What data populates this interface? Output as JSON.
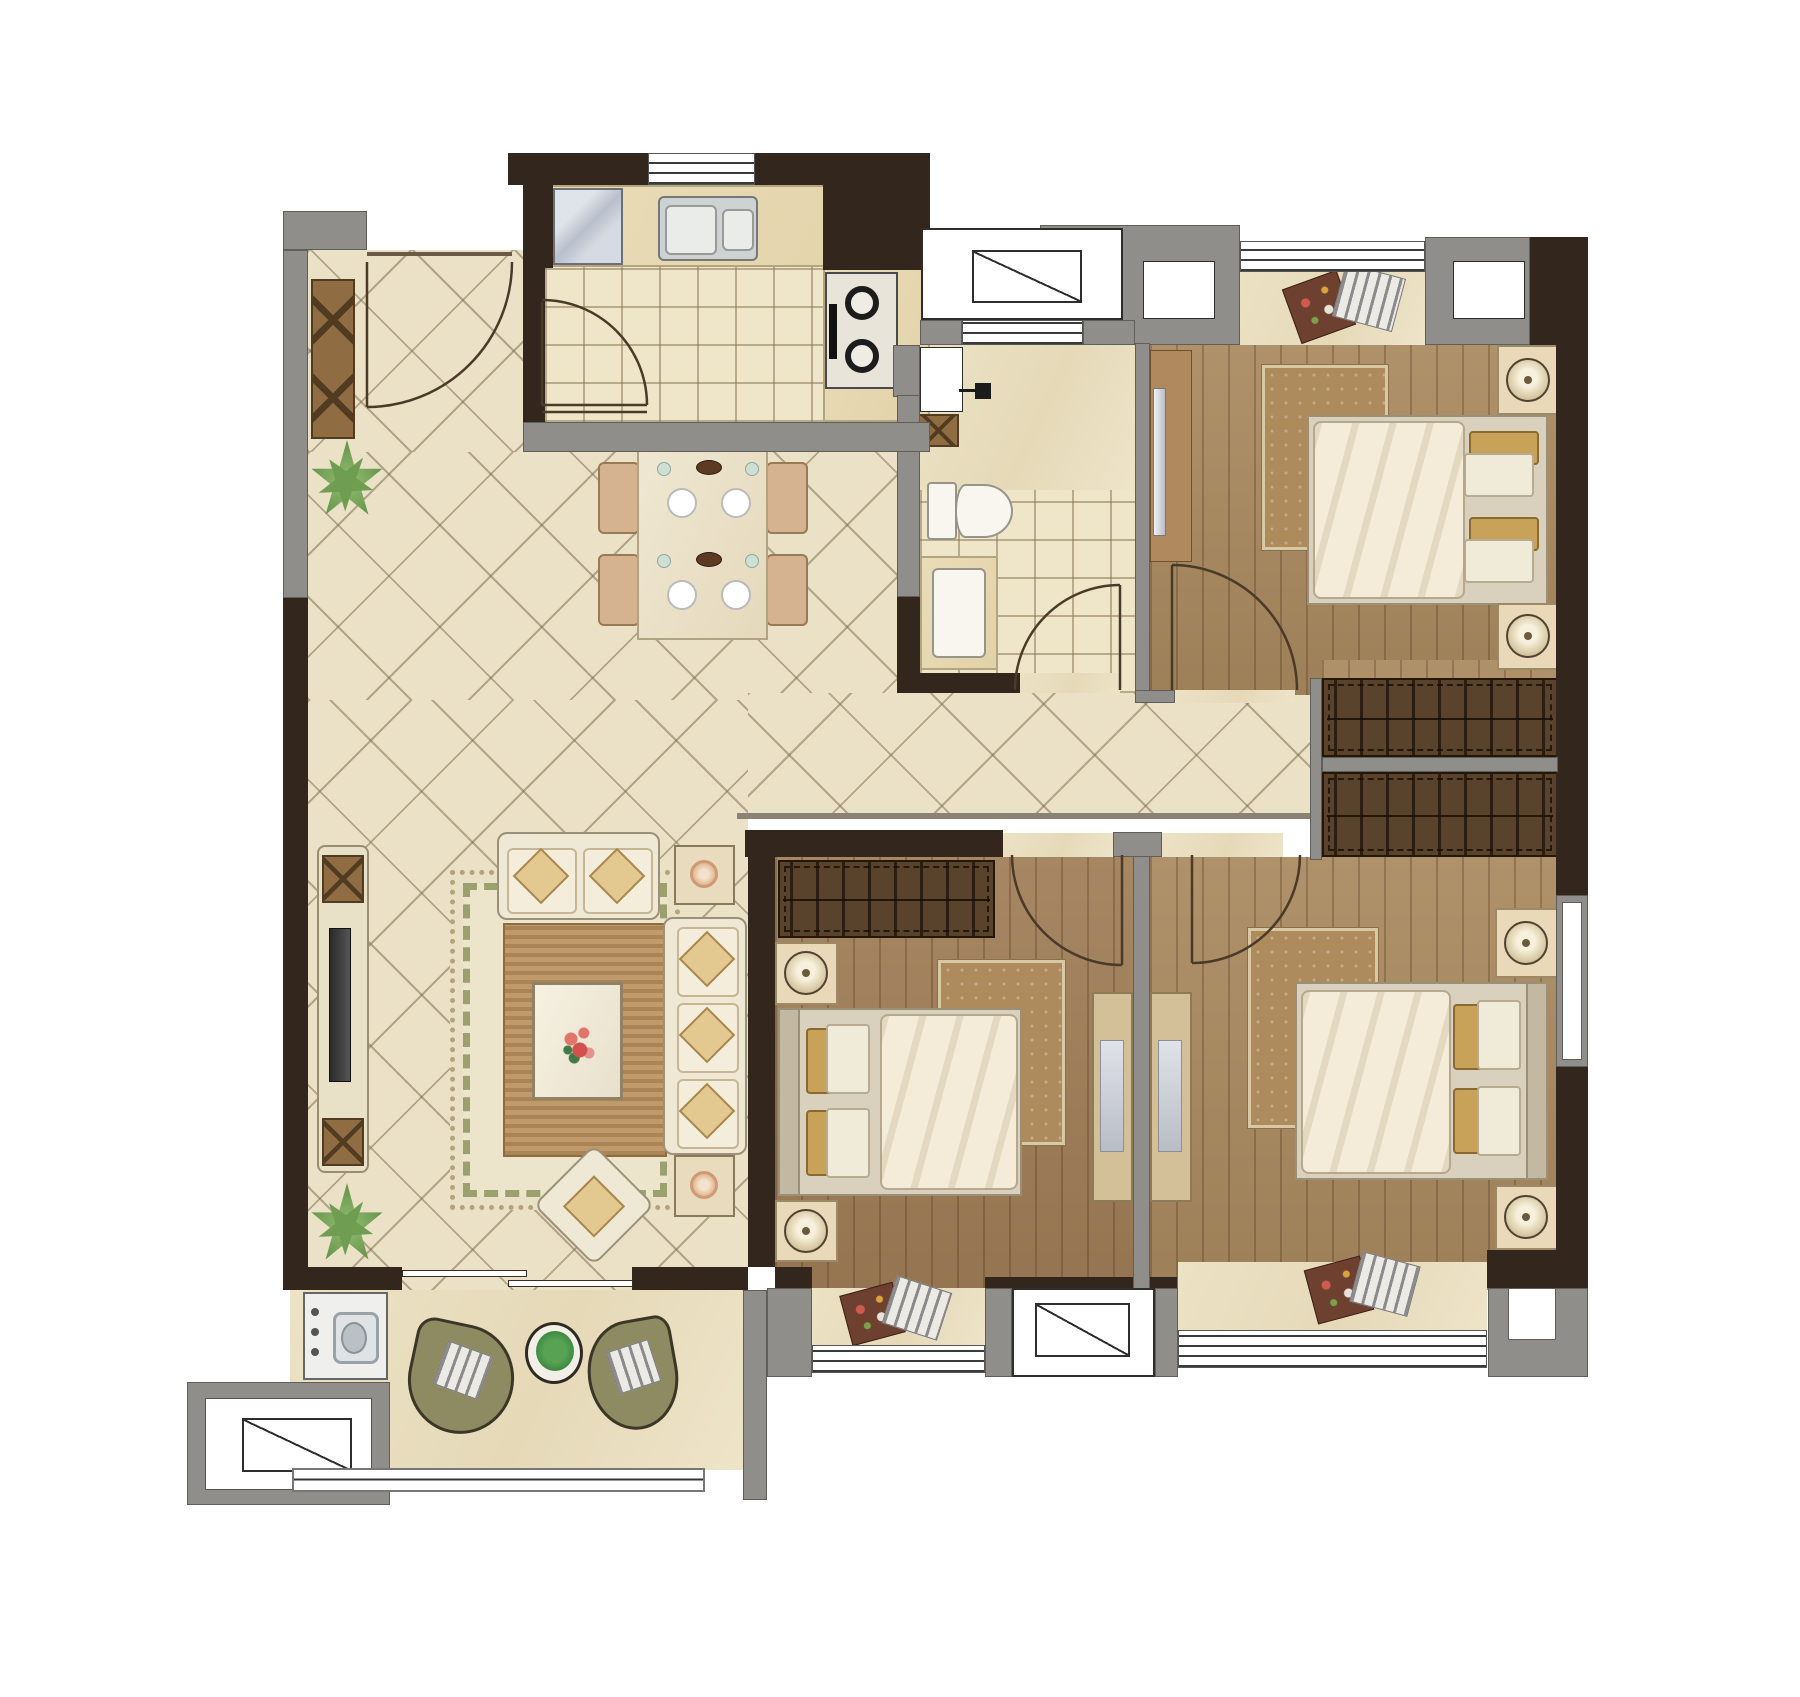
{
  "canvas": {
    "width": 1800,
    "height": 1697,
    "background": "#ffffff"
  },
  "palette": {
    "wall_structural": "#33261c",
    "wall_partition": "#8f8e8a",
    "diamond_tile_floor": "#ebe1c7",
    "square_tile_floor": "#efe5c9",
    "wood_floor": "#a9895f",
    "marble_sill": "#e9ddc0",
    "counter_marble": "#e7dcba",
    "dark_wood_furniture": "#59432c",
    "sofa_cream": "#efe8d4",
    "cushion_tan": "#c7a258",
    "balcony_chair_olive": "#8e8a62",
    "plant_green": "#6f9e52",
    "appliance_steel": "#c9cdd4"
  },
  "rooms": {
    "entry": {
      "name": "entry hall",
      "floor": "diamond tile",
      "items": [
        "entry swing door",
        "shoe cabinet",
        "potted plant"
      ]
    },
    "kitchen": {
      "name": "kitchen",
      "floor": "square tile",
      "items": [
        "refrigerator",
        "L-shaped counter",
        "double-bowl sink",
        "two-burner gas cooktop",
        "window",
        "swing door"
      ]
    },
    "dining": {
      "name": "dining area",
      "floor": "diamond tile",
      "items": [
        "dining table for four",
        "4 dining chairs",
        "4 place settings"
      ]
    },
    "living": {
      "name": "living room",
      "floor": "diamond tile",
      "items": [
        "tv console",
        "television",
        "fringed area rug",
        "loveseat",
        "three-seat sofa",
        "coffee table",
        "flower centerpiece",
        "2 end tables with lamps",
        "ottoman",
        "2 potted plants",
        "sliding balcony door"
      ]
    },
    "corridor": {
      "name": "hallway",
      "floor": "diamond tile",
      "items": []
    },
    "bathroom": {
      "name": "bathroom",
      "floor": "marble + square tile",
      "items": [
        "toilet",
        "vanity washbasin",
        "washer tap",
        "storage cabinet",
        "window",
        "swing door"
      ]
    },
    "bedroom1": {
      "name": "bedroom top right",
      "floor": "wood plank",
      "items": [
        "double bed",
        "duvet",
        "4 pillows",
        "2 nightstands with lamps",
        "area rug",
        "tv panel",
        "wardrobe",
        "bay window seat with 2 cushions",
        "swing door"
      ]
    },
    "bedroom2": {
      "name": "bedroom bottom middle",
      "floor": "wood plank",
      "items": [
        "double bed",
        "duvet",
        "4 pillows",
        "2 nightstands with lamps",
        "area rug",
        "wardrobe",
        "desk",
        "bay window seat with 2 cushions",
        "swing door"
      ]
    },
    "bedroom3": {
      "name": "bedroom bottom right",
      "floor": "wood plank",
      "items": [
        "double bed",
        "duvet",
        "4 pillows",
        "2 nightstands with lamps",
        "area rug",
        "wardrobe",
        "desk",
        "bay window seat with 2 cushions",
        "swing door"
      ]
    },
    "balcony": {
      "name": "balcony",
      "floor": "marble",
      "items": [
        "washing machine",
        "2 lounge chairs",
        "round tea table",
        "potted plant",
        "bay window",
        "railing"
      ]
    }
  },
  "doors": {
    "swing": [
      "entry",
      "kitchen",
      "bathroom",
      "bedroom1",
      "bedroom2",
      "bedroom3"
    ],
    "sliding": [
      "living-to-balcony"
    ]
  },
  "windows": [
    "kitchen window",
    "bathroom clerestory window",
    "light-well box with diagonal glazing symbol",
    "square wall window x2",
    "bay window seat railing x3",
    "protruding bay window with diagonal symbol x2",
    "right wall window",
    "balcony railing"
  ]
}
